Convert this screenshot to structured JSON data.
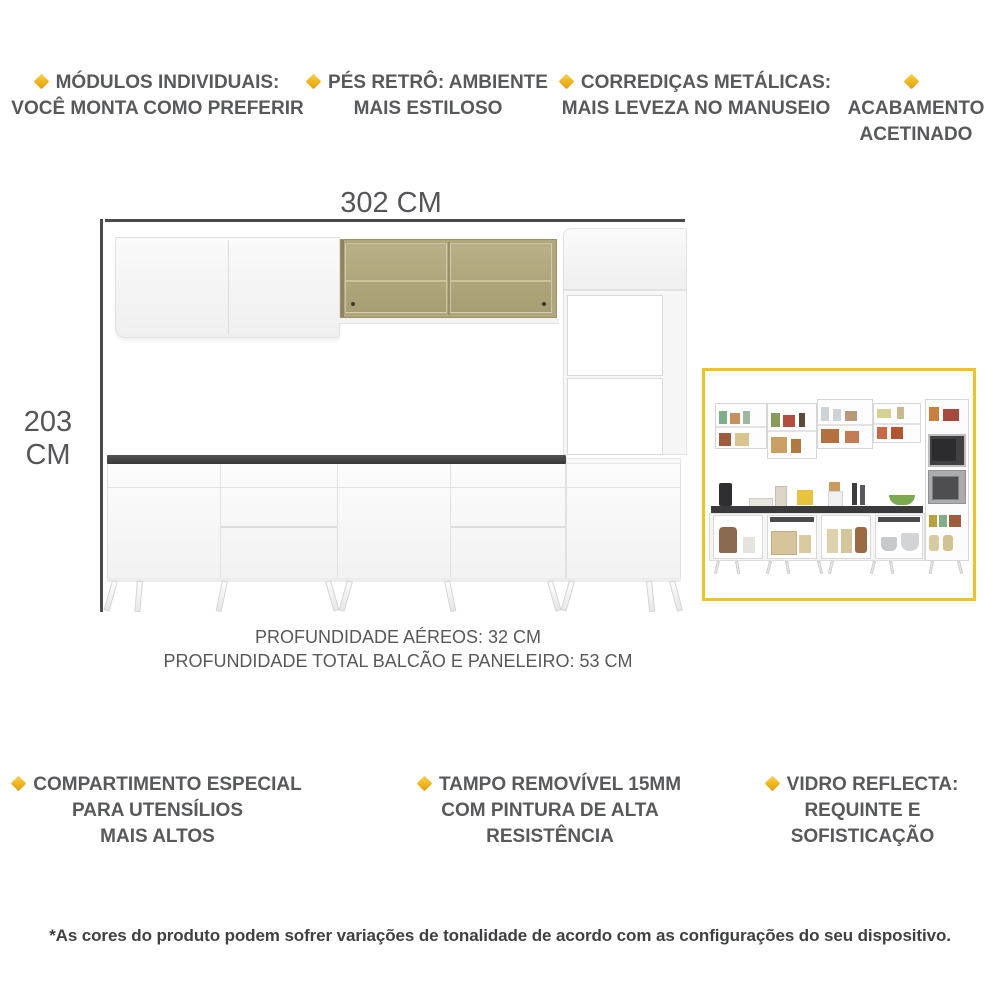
{
  "features_top": [
    {
      "line1": "MÓDULOS INDIVIDUAIS:",
      "line2": "VOCÊ MONTA COMO PREFERIR"
    },
    {
      "line1": "PÉS RETRÔ: AMBIENTE",
      "line2": "MAIS ESTILOSO"
    },
    {
      "line1": "CORREDIÇAS METÁLICAS:",
      "line2": "MAIS LEVEZA NO MANUSEIO"
    },
    {
      "line1": "ACABAMENTO",
      "line2": "ACETINADO"
    }
  ],
  "features_bottom": [
    {
      "line1": "COMPARTIMENTO ESPECIAL",
      "line2": "PARA UTENSÍLIOS",
      "line3": "MAIS ALTOS"
    },
    {
      "line1": "TAMPO REMOVÍVEL 15MM",
      "line2": "COM PINTURA DE ALTA",
      "line3": "RESISTÊNCIA"
    },
    {
      "line1": "VIDRO REFLECTA:",
      "line2": "REQUINTE E",
      "line3": "SOFISTICAÇÃO"
    }
  ],
  "dimensions": {
    "width": "302 CM",
    "height": "203 CM",
    "depth_aereos": "PROFUNDIDADE AÉREOS: 32 CM",
    "depth_total": "PROFUNDIDADE TOTAL BALCÃO E PANELEIRO: 53 CM"
  },
  "footer": {
    "disclaimer": "*As cores do produto podem sofrer variações de tonalidade de acordo com as configurações do seu dispositivo."
  },
  "colors": {
    "accent_yellow": "#F0B41C",
    "inset_border": "#F2C31F",
    "text_gray": "#58595B",
    "glass_tan": "#B2A77A",
    "countertop_dark": "#3E3E3E",
    "dimension_line": "#4A4B4D"
  }
}
